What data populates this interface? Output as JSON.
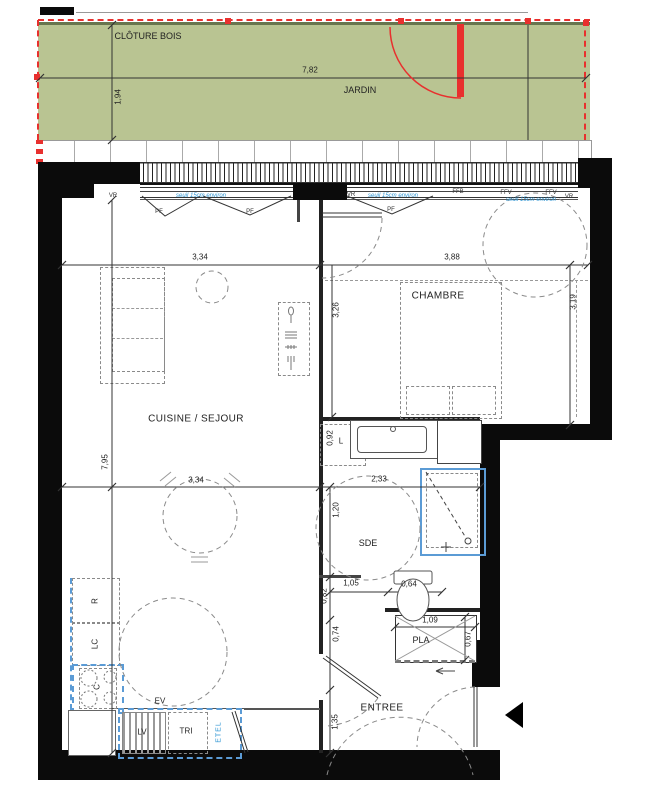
{
  "plan": {
    "garden": {
      "fence_label": "CLÔTURE BOIS",
      "label": "JARDIN"
    },
    "rooms": {
      "living": "CUISINE / SEJOUR",
      "bedroom": "CHAMBRE",
      "shower_room": "SDE",
      "entry": "ENTREE",
      "closet": "PLA"
    },
    "fixtures": {
      "fridge": "R",
      "laundry_column": "LC",
      "cooktop": "C",
      "sink": "EV",
      "dishwasher": "LV",
      "waste_sorting": "TRI",
      "electrical_panel": "ETEL",
      "washer": "L"
    },
    "openings": {
      "roller_shutter": "VR",
      "french_door": "PF",
      "window_ffb": "FFB",
      "window_ffv": "FFV",
      "sill_note": "seuil 15cm environ"
    },
    "dims": {
      "garden_w": "7,82",
      "garden_d": "1,94",
      "living_w": "3,34",
      "bedroom_w": "3,88",
      "living_inner": "3,26",
      "bedroom_d": "3,19",
      "living_d": "7,95",
      "living_w2": "3,34",
      "sde_w": "2,33",
      "sde_d": "1,20",
      "wc_w": "1,05",
      "wc_nook": "0,64",
      "wc_d": "0,82",
      "hall_d": "0,74",
      "entry_d": "1,35",
      "closet_w": "1,09",
      "closet_d": "0,67",
      "washer_w": "0,92"
    }
  },
  "colors": {
    "garden_green": "#b9c492",
    "fence_red": "#e8302e",
    "fixture_blue": "#5b9bd5",
    "note_blue": "#2e95d3"
  }
}
